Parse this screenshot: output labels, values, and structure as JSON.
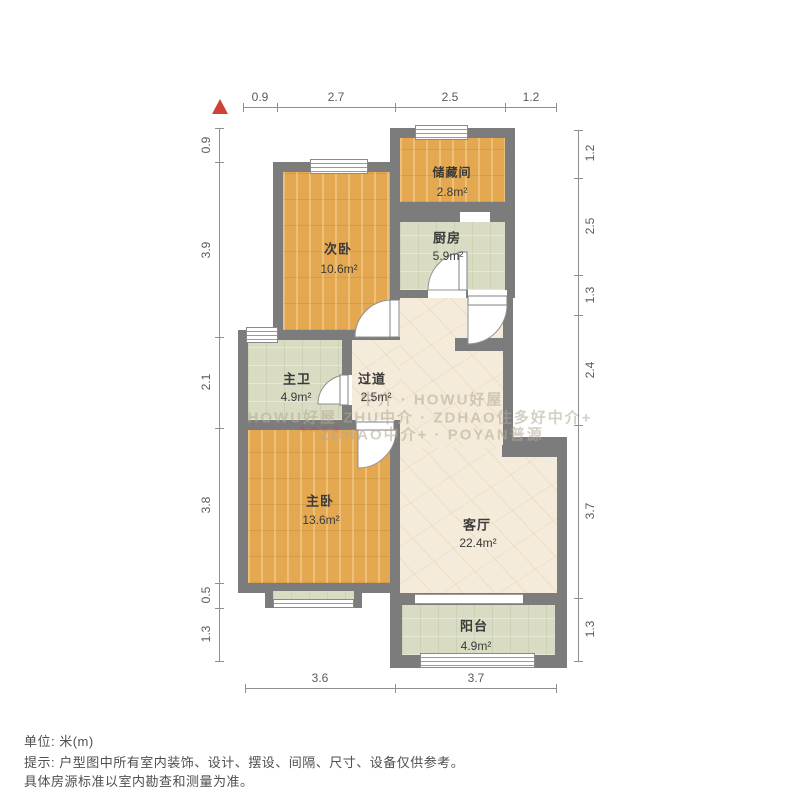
{
  "north_arrow": {
    "symbol": "▲"
  },
  "rooms": {
    "storage": {
      "name": "储藏间",
      "area": "2.8m²"
    },
    "kitchen": {
      "name": "厨房",
      "area": "5.9m²"
    },
    "bedroom2": {
      "name": "次卧",
      "area": "10.6m²"
    },
    "bathroom": {
      "name": "主卫",
      "area": "4.9m²"
    },
    "hallway": {
      "name": "过道",
      "area": "2.5m²"
    },
    "master": {
      "name": "主卧",
      "area": "13.6m²"
    },
    "living": {
      "name": "客厅",
      "area": "22.4m²"
    },
    "balcony": {
      "name": "阳台",
      "area": "4.9m²"
    }
  },
  "dimensions": {
    "top": [
      "0.9",
      "2.7",
      "2.5",
      "1.2"
    ],
    "left": [
      "0.9",
      "3.9",
      "2.1",
      "3.8",
      "0.5",
      "1.3"
    ],
    "right": [
      "1.2",
      "2.5",
      "1.3",
      "2.4",
      "3.7",
      "1.3"
    ],
    "bottom": [
      "3.6",
      "3.7"
    ]
  },
  "watermark": {
    "line1": "中介 · HOWU好屋",
    "line2": "HOWU好屋 ZHU中介 · ZDHAO住多好中介+",
    "line3": "ZDHAO中介+ · POYAN普源",
    "stars": "＊＊＊＊"
  },
  "footer": {
    "unit": "单位: 米(m)",
    "tip1": "提示: 户型图中所有室内装饰、设计、摆设、间隔、尺寸、设备仅供参考。",
    "tip2": "具体房源标准以室内勘查和测量为准。"
  },
  "colors": {
    "wall": "#7c7c7c",
    "wood_floor": "#e4a851",
    "tile_floor": "#d9dcc2",
    "marble_floor": "#f4ebda",
    "north_arrow": "#ce4237"
  }
}
